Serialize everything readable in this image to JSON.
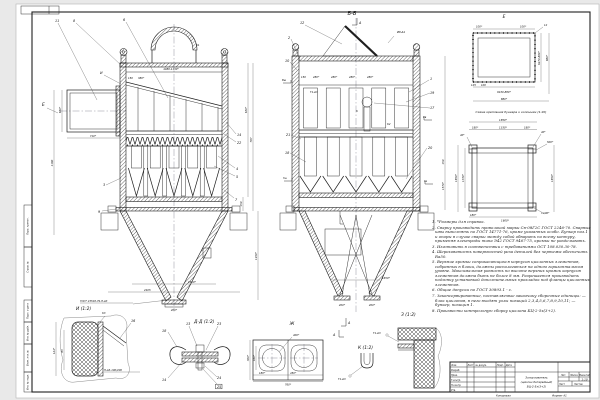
{
  "frame": {
    "margins": [
      "Перв. примен.",
      "Справ. №",
      "Подп. и дата",
      "Инв. № дубл.",
      "Взам. инв. №",
      "Инв. № подл."
    ]
  },
  "front": {
    "pos11": "11",
    "pos8": "8",
    "pos6": "6",
    "posI": "И",
    "viewE": "Е",
    "pos3": "3",
    "pos9": "9",
    "pos7": "7",
    "pos14": "14",
    "pos22": "22",
    "pos4": "4",
    "pos5": "5",
    "k1": "К1",
    "d650": "650*",
    "d710": "710*",
    "d1180": "1180",
    "d150": "150",
    "d380": "380*",
    "d4080": "4080-1130*",
    "d630": "630*",
    "d787": "787",
    "d150r": "150",
    "d1450": "1450*",
    "d1650": "1650*",
    "d2405": "2405",
    "d200": "200*",
    "weld_gost": "ГОСТ 23518-79-П-Δ3"
  },
  "section": {
    "title": "Б-Б",
    "markA": "А",
    "pos12": "12",
    "pos2": "2",
    "pos10": "10",
    "pos1": "1",
    "pos19": "19",
    "pos17": "17",
    "pos21": "21",
    "pos18": "18",
    "pos20": "20",
    "vsh": "Вш",
    "vv": "Вв",
    "gsh": "Гш",
    "gv": "Гв",
    "k2": "К2",
    "k": "К",
    "t1": "Т1-Δ3",
    "w8": "Ø8-Δ4",
    "d150": "150",
    "d280": "280*",
    "d1570": "1570*",
    "d150r": "150",
    "d1650": "1650*",
    "d200": "200*"
  },
  "viewE": {
    "title": "Е",
    "d100": "100*",
    "d12": "12",
    "d125": "125",
    "d100b": "100",
    "dv": "6470-880*",
    "d880": "880*",
    "db": "6430-880*"
  },
  "scheme": {
    "caption": "Схема крепления бункера к колоннам (1:20)",
    "d1850": "1850*",
    "d180": "180*",
    "d1330": "1330*",
    "d40": "40*",
    "d500": "500*",
    "d1600": "1600*",
    "dL": "∟100*"
  },
  "di": {
    "title": "И (1:2)",
    "pos16": "16",
    "k3": "К3",
    "d124": "124*",
    "d83": "83",
    "glue": "Н-Δ3-100/200",
    "gost": "ГОСТ 23518-79-П-Δ3"
  },
  "dd": {
    "title": "Д-Д (1:2)",
    "p18": "18",
    "p13": "13",
    "p23": "23",
    "p14": "14",
    "p24": "24",
    "p25": "25"
  },
  "zh": {
    "title": "Ж",
    "d400": "400*",
    "d180": "180*",
    "d450": "450*",
    "d760": "760*",
    "d300": "300*",
    "d160": "160*",
    "markA": "А"
  },
  "dk": {
    "title": "К (1:2)",
    "t1": "Т1-Δ3"
  },
  "dz": {
    "title": "З (1:2)",
    "t1": "Т1-Δ3"
  },
  "notes": {
    "items": [
      "1. *Размеры для справок.",
      "2. Сварку производить проволокой марки Св-08Г2С ГОСТ 2246-70. Сварные швы выполнять по ГОСТ 14771-76, кроме указанных особо. Бункер поз.1 и опоры в случае сварки между собой обварить по всему контуру, применяя электроды типа Э42 ГОСТ 9467-75, кромки не разделывать.",
      "3. Изготовить в соответствии с требованиями ОСТ 108.030.30-78.",
      "4. Шероховатость поверхностей реза деталей без чертежа обеспечить Ra50.",
      "5. Верхние кромки соприкасающихся корпусов циклонных элементов, собранных в блоки, должны располагаться на одном горизонтальном уровне. Максимальная разность по высоте верхних кромок корпусов элементов должна быть не более 8 мм. Разрешается производить подгонку установкой дополнительных прокладок под фланцы циклонных элементов.",
      "6. Общие допуски по ГОСТ 30893.1 - с.",
      "7. Законсервированные, поставляемые заказчику сборочные единицы: — блок циклонов, в него входят узлы позиций 2,3,4,5,6,7,8,9,10,11; — бункер, позиция 1.",
      "8. Произвести контрольную сборку циклона БЦ-2-5х(3+2)."
    ]
  },
  "stamp": {
    "cols": [
      "Изм.",
      "Лист",
      "№ докум.",
      "Подп.",
      "Дата"
    ],
    "rows": [
      "Разраб.",
      "Пров.",
      "Т.контр.",
      "Н.контр.",
      "Утв."
    ],
    "title1": "Золоуловитель",
    "title2": "(циклон батарейный)",
    "title3": "БЦ-2-5х(3+2)",
    "lit": "Лит.",
    "mass": "Масса",
    "scale_l": "Масштаб",
    "scale": "1:10",
    "sheet": "Лист",
    "sheets": "Листов",
    "copied": "Копировал",
    "format": "Формат А1"
  }
}
